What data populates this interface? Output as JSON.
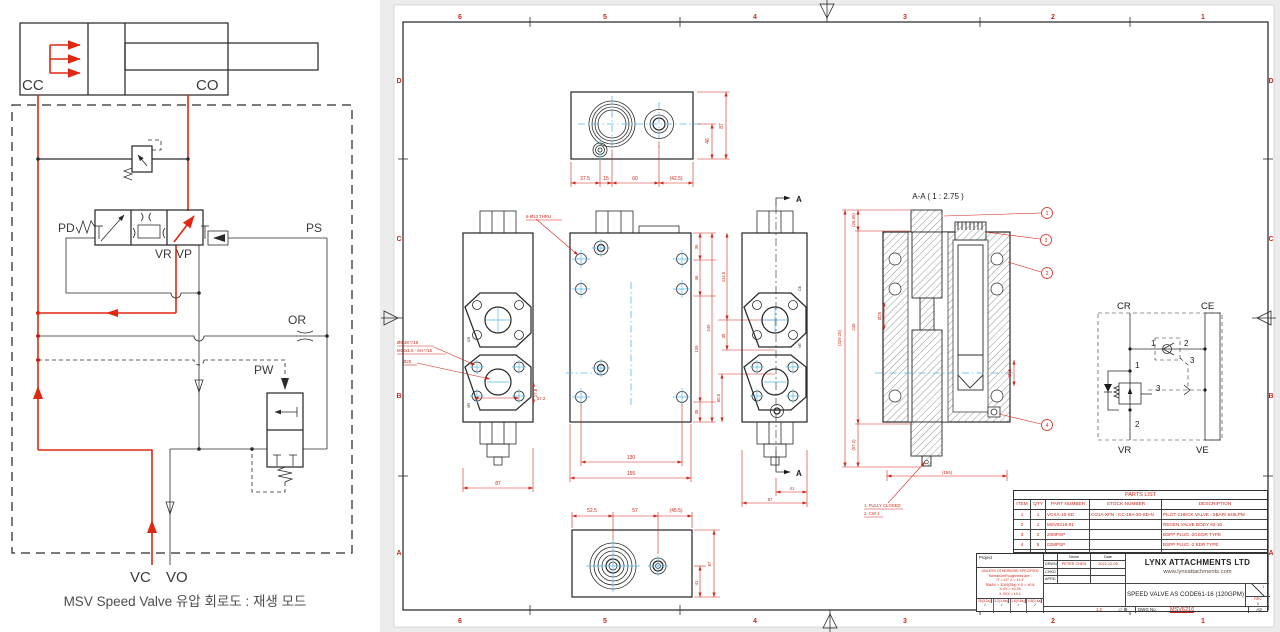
{
  "schematic": {
    "caption": "MSV Speed Valve 유압 회로도 : 재생 모드",
    "labels": {
      "cc": "CC",
      "co": "CO",
      "pd": "PD",
      "ps": "PS",
      "vr": "VR",
      "vp": "VP",
      "or": "OR",
      "pw": "PW",
      "vc": "VC",
      "vo": "VO"
    }
  },
  "sheet": {
    "zones": {
      "n1": "6",
      "n2": "5",
      "n3": "4",
      "n4": "3",
      "n5": "2",
      "n6": "1",
      "l1": "D",
      "l2": "C",
      "l3": "B",
      "l4": "A"
    },
    "top_view": {
      "d1": "37.5",
      "d2": "15",
      "d3": "60",
      "d4": "(42.5)",
      "d5": "46",
      "d6": "87"
    },
    "left_view": {
      "w": "87",
      "d1": "27.8",
      "d2": "57.2",
      "c1": "Ø6.38 ▽18",
      "c2": "M10x1.5 - 6H ▽15",
      "c3": "Ø25",
      "f1": "CR",
      "f2": "VR"
    },
    "center_view": {
      "note": "6-Ø13 THRU",
      "d130": "130",
      "d155": "155",
      "c1": "35",
      "c2": "46",
      "c3": "135",
      "c4": "35",
      "d245": "245",
      "e1": "114.5",
      "e2": "35",
      "e3": "60.5"
    },
    "right_view": {
      "a": "A",
      "d41": "41",
      "d87": "87",
      "f1": "CE",
      "f2": "VE"
    },
    "bottom_view": {
      "d1": "52.5",
      "d2": "57",
      "d3": "(45.5)",
      "d4": "41",
      "d5": "87"
    },
    "section": {
      "title": "A-A ( 1 : 2.75 )",
      "b1": "1",
      "b2": "3",
      "b3": "2",
      "b4": "4",
      "d1": "(26.95)",
      "d2": "245",
      "d3": "(329.15)",
      "d4": "(57.2)",
      "d5": "Ø25",
      "d6": "Ø26",
      "d7": "(155)",
      "note1": "1. FULLY CLOSED",
      "note2": "2. CW 1"
    },
    "mini": {
      "cr": "CR",
      "ce": "CE",
      "vr": "VR",
      "ve": "VE",
      "n1": "1",
      "n2": "2",
      "n3": "3"
    }
  },
  "parts_list": {
    "title": "PARTS LIST",
    "headers": [
      "ITEM",
      "QTY",
      "PART NUMBER",
      "STOCK NUMBER",
      "DESCRIPTION"
    ],
    "rows": [
      [
        "1",
        "1",
        "VCXA-10-SD",
        "CO1A-XFN : CC-19A-30-SD-N",
        "PILOT CHECK VALVE - 5BAR/ 640LPM"
      ],
      [
        "2",
        "1",
        "MSV6216-01",
        "",
        "REGEN VALVE BODY 62-16"
      ],
      [
        "3",
        "2",
        "20MPSP",
        "",
        "BSPP PLUG -20 EDR TYPE"
      ],
      [
        "4",
        "5",
        "02MPSP",
        "",
        "BSPP PLUG -2 EDR TYPE"
      ],
      [
        "5",
        "1",
        "VCB-10-28-3A",
        "CB0A-LHN : CB-19A-3C-H-L",
        "COUNTERBALANCE (480LPM) : 70~280BAR"
      ]
    ]
  },
  "title_block": {
    "project_label": "Project",
    "tol1": "UNLESS OTHERWISE SPECIFIED",
    "tol2": "Tolerance/Roughness are :",
    "tol3": "IT = ±2°   X = ±1.5",
    "tol4": "RMAX = 3200(25a)   X.X = ±0.8",
    "tol5": "X.XX = ±0.25",
    "tol6": "X.XXX = ±0.1",
    "rough1": "25(3.2a)",
    "rough2": "3.2(1.6a)",
    "rough3": "1.6(0.8a)",
    "rough4": "0.8(0.4a)",
    "check": "✓",
    "name_header": "Name",
    "date_header": "Date",
    "row1_role": "DRWN",
    "row1_name": "PETER CHEN",
    "row1_date": "2022-12-05",
    "row2_role": "CHKD",
    "row3_role": "APRD",
    "company": "LYNX ATTACHMENTS LTD",
    "website": "www.lynxattachments.com",
    "drawing_title": "SPEED VALVE AS CODE61-16 (120GPM)",
    "scale": "1:2",
    "proj_icon": "▱ ⊕",
    "dwg_label": "DWG No.",
    "dwg_no": "MSV6216",
    "rev_label": "REV",
    "rev_val": "1",
    "size": "A3"
  }
}
